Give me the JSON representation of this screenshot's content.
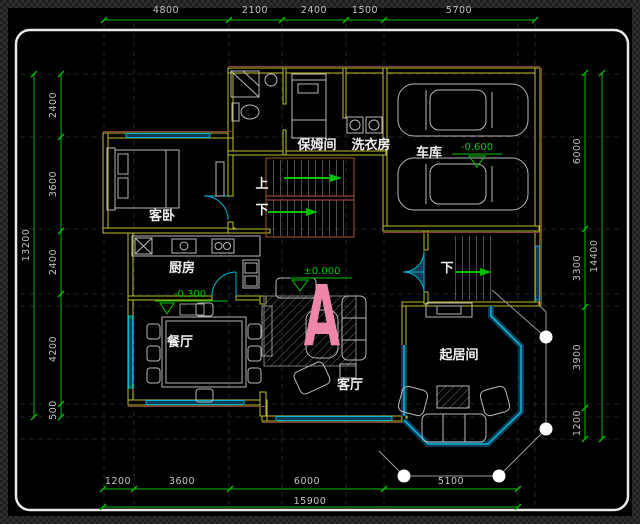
{
  "dims": {
    "top": [
      "4800",
      "2100",
      "2400",
      "1500",
      "5700"
    ],
    "bottom": [
      "1200",
      "3600",
      "6000",
      "5100"
    ],
    "bottom_total": "15900",
    "left": [
      "2400",
      "3600",
      "2400",
      "4200",
      "500"
    ],
    "left_total": "13200",
    "right": [
      "6000",
      "3300",
      "3900",
      "1200"
    ],
    "right_total": "14400"
  },
  "rooms": {
    "nanny": "保姆间",
    "laundry": "洗衣房",
    "garage": "车库",
    "guest_bedroom": "客卧",
    "kitchen": "厨房",
    "dining": "餐厅",
    "living": "客厅",
    "sitting": "起居间"
  },
  "stairs": {
    "up": "上",
    "down": "下",
    "exterior_down": "下"
  },
  "levels": {
    "garage": "-0.600",
    "main": "±0.000",
    "kitchen": "-0.300"
  },
  "marker": {
    "label": "A"
  },
  "colors": {
    "dimension_green": "#00c000",
    "wall_yellow": "#c0c02a",
    "window_cyan": "#00b4d2",
    "window_fill": "#0d3b57",
    "accent_red": "#8c3c3c",
    "rail_brown": "#8a4a2a",
    "marker_pink": "#ee85ab",
    "background": "#000000"
  }
}
